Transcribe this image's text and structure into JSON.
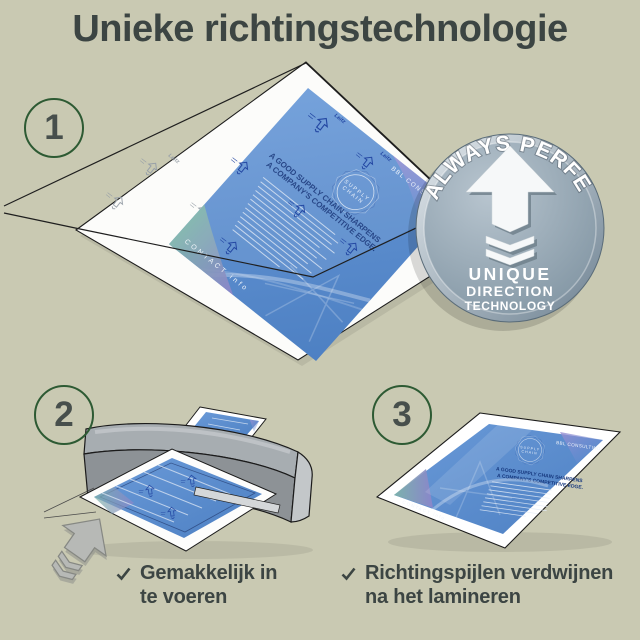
{
  "title": "Unieke richtingstechnologie",
  "step1_number": "1",
  "step2_number": "2",
  "step3_number": "3",
  "badge_arc": "ALWAYS PERFECT!",
  "badge_line1": "UNIQUE",
  "badge_line2": "DIRECTION",
  "badge_line3": "TECHNOLOGY",
  "flyer_brand": "BBL CONSULTING",
  "flyer_logo_line1": "SUPPLY",
  "flyer_logo_line2": "CHAIN",
  "flyer_headline_line1": "A GOOD SUPPLY CHAIN SHARPENS",
  "flyer_headline_line2": "A COMPANY'S COMPETITIVE EDGE.",
  "flyer_footer": "CONTACT info",
  "pouch_brand": "Leitz",
  "benefit1_line1": "Gemakkelijk in",
  "benefit1_line2": "te voeren",
  "benefit2_line1": "Richtingspijlen verdwijnen",
  "benefit2_line2": "na het lamineren",
  "icon_check": "check-icon",
  "icon_direction_arrow": "direction-arrow-icon",
  "colors": {
    "background": "#c9c9b2",
    "heading_text": "#3c4543",
    "accent_green": "#2d5a33",
    "flyer_blue": "#5b8ed3",
    "print_navy": "#1c3f9e",
    "badge_gray": "#8ea1ae",
    "machine_gray": "#8d9296",
    "pouch_white": "#ffffff"
  }
}
